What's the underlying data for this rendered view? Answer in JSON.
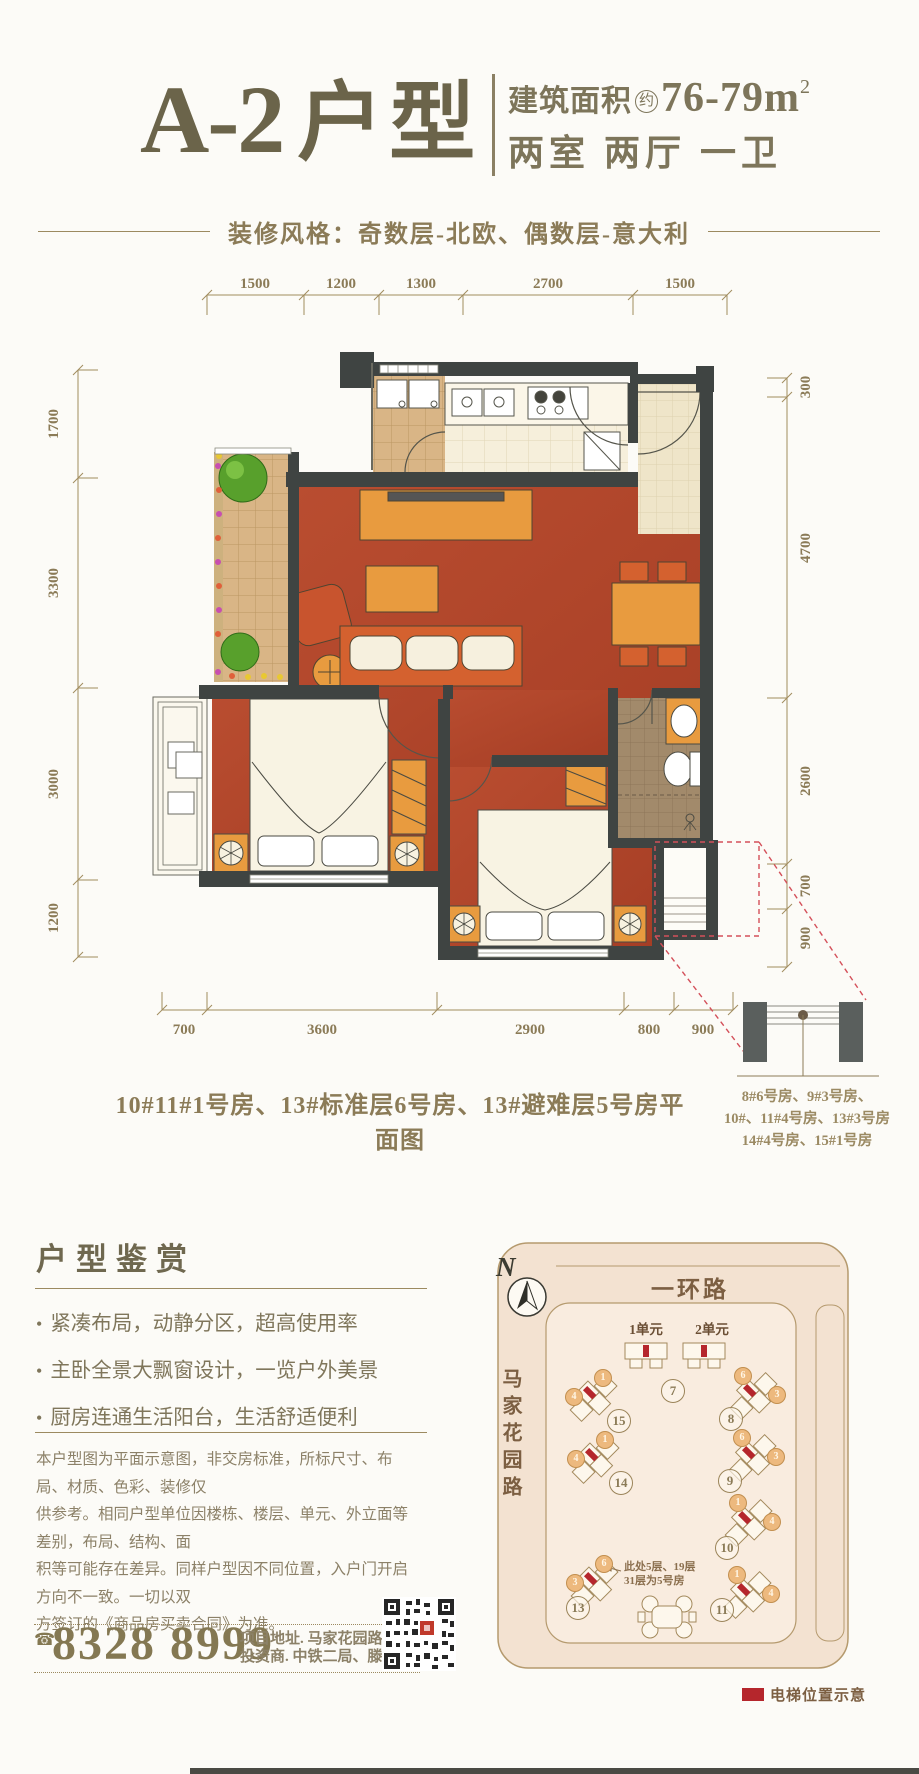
{
  "header": {
    "title_code": "A-2",
    "title_suffix": "户型",
    "area_label": "建筑面积",
    "area_circle": "约",
    "area_value": "76-79m",
    "area_sup": "2",
    "rooms": "两室 两厅 一卫",
    "style_banner": "装修风格：奇数层-北欧、偶数层-意大利"
  },
  "plan": {
    "dims_top": [
      "1500",
      "1200",
      "1300",
      "2700",
      "1500"
    ],
    "dims_left": [
      "1700",
      "3300",
      "3000",
      "1200"
    ],
    "dims_right": [
      "300",
      "4700",
      "2600",
      "700",
      "900"
    ],
    "dims_bottom": [
      "700",
      "3600",
      "2900",
      "800",
      "900"
    ],
    "caption": "10#11#1号房、13#标准层6号房、13#避难层5号房平面图",
    "elevator_note": [
      "8#6号房、9#3号房、",
      "10#、11#4号房、13#3号房",
      "14#4号房、15#1号房"
    ]
  },
  "features": {
    "heading": "户型鉴赏",
    "items": [
      "紧凑布局，动静分区，超高使用率",
      "主卧全景大飘窗设计，一览户外美景",
      "厨房连通生活阳台，生活舒适便利"
    ]
  },
  "disclaimer": {
    "lines": [
      "本户型图为平面示意图，非交房标准，所标尺寸、布局、材质、色彩、装修仅",
      "供参考。相同户型单位因楼栋、楼层、单元、外立面等差别，布局、结构、面",
      "积等可能存在差异。同样户型因不同位置，入户门开启方向不一致。一切以双",
      "方签订的《商品房买卖合同》为准。"
    ]
  },
  "contact": {
    "phone_icon": "☎",
    "phone": "8328 8999",
    "address": "项目地址. 马家花园路16号",
    "investor": "投资商. 中铁二局、滕王阁地产"
  },
  "sitemap": {
    "compass_label": "N",
    "road_top": "一环路",
    "road_left": "马家花园路",
    "unit_labels": [
      "1单元",
      "2单元"
    ],
    "buildings": [
      {
        "id": "7"
      },
      {
        "id": "15",
        "u_top": "1",
        "u_side": "4"
      },
      {
        "id": "8",
        "u_top": "6",
        "u_side": "3"
      },
      {
        "id": "14",
        "u_top": "1",
        "u_side": "4"
      },
      {
        "id": "9",
        "u_top": "6",
        "u_side": "3"
      },
      {
        "id": "13",
        "u_top": "6",
        "u_side": "3"
      },
      {
        "id": "10",
        "u_top": "1",
        "u_side": "4"
      },
      {
        "id": "11",
        "u_top": "1",
        "u_side": "4"
      }
    ],
    "note_lines": [
      "此处5层、19层",
      "31层为5号房"
    ],
    "legend_label": "电梯位置示意"
  },
  "colors": {
    "accent_gold": "#8b7b57",
    "floor_red": "#b0452c",
    "wall_dark": "#3f4442",
    "elevator_red": "#b5262c"
  }
}
